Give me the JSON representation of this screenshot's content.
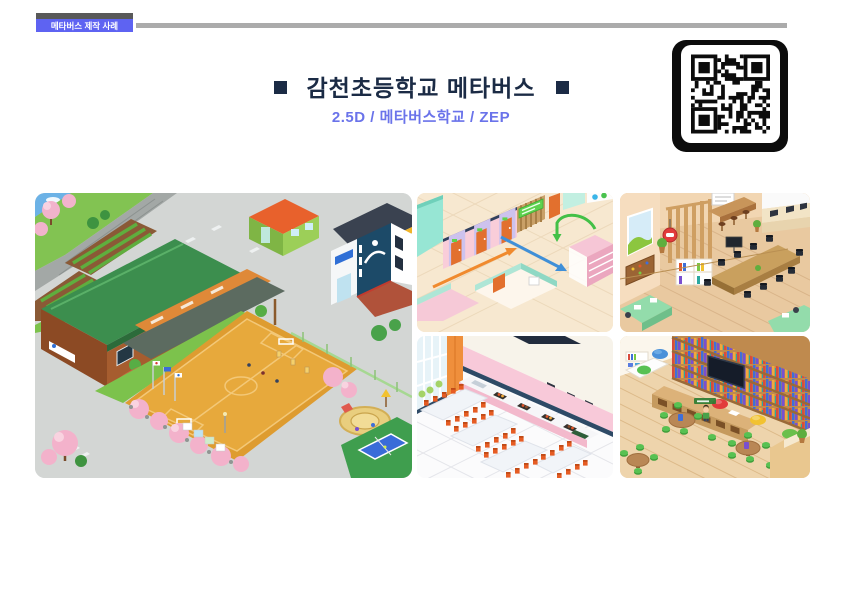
{
  "colors": {
    "page-bg": "#ffffff",
    "accent-blue": "#5e63f2",
    "subtitle-blue": "#6a73ea",
    "title-navy": "#1b2b45",
    "rule-gray": "#ababab",
    "strip-gray": "#595959",
    "qr-frame-black": "#0c0c0c"
  },
  "header": {
    "badge_label": "메타버스 제작 사례",
    "title": "감천초등학교 메타버스",
    "title_bullet": "■",
    "subtitle": "2.5D / 메타버스학교 / ZEP"
  },
  "qr": {
    "alt": "QR 코드"
  },
  "gallery": {
    "items": [
      {
        "name": "campus-overview",
        "alt": "학교 전경 맵 - 운동장, 교사동, 체육관, 놀이터, 테니스장"
      },
      {
        "name": "hallway",
        "alt": "복도 맵 - 이동 동선 화살표"
      },
      {
        "name": "meeting-room",
        "alt": "카페형 협의실 맵"
      },
      {
        "name": "cafeteria",
        "alt": "급식실 맵"
      },
      {
        "name": "library",
        "alt": "도서관 맵"
      }
    ]
  }
}
